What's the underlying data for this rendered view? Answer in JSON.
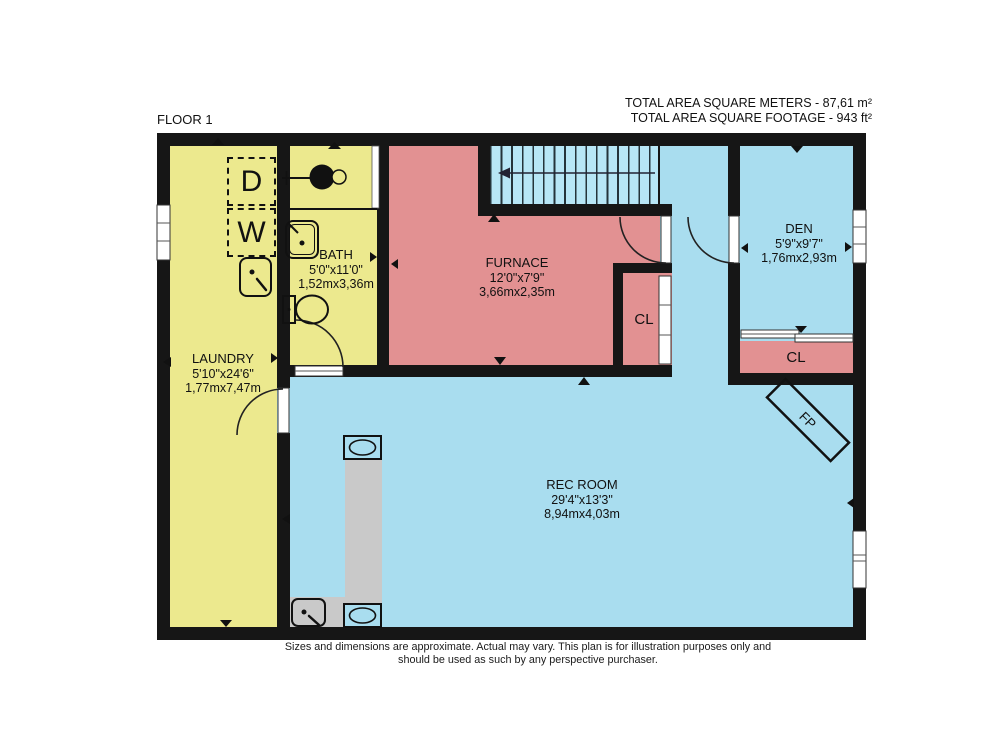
{
  "header": {
    "floor_label": "FLOOR 1",
    "total_area_meters": "TOTAL AREA SQUARE METERS - 87,61 m²",
    "total_area_footage": "TOTAL AREA SQUARE FOOTAGE  - 943 ft²"
  },
  "rooms": {
    "laundry": {
      "name": "LAUNDRY",
      "size_ft": "5'10\"x24'6\"",
      "size_m": "1,77mx7,47m"
    },
    "bath": {
      "name": "BATH",
      "size_ft": "5'0\"x11'0\"",
      "size_m": "1,52mx3,36m"
    },
    "furnace": {
      "name": "FURNACE",
      "size_ft": "12'0\"x7'9\"",
      "size_m": "3,66mx2,35m"
    },
    "den": {
      "name": "DEN",
      "size_ft": "5'9\"x9'7\"",
      "size_m": "1,76mx2,93m"
    },
    "rec_room": {
      "name": "REC ROOM",
      "size_ft": "29'4\"x13'3\"",
      "size_m": "8,94mx4,03m"
    },
    "closet_hall": {
      "label": "CL"
    },
    "closet_den": {
      "label": "CL"
    }
  },
  "appliances": {
    "dryer": "D",
    "washer": "W",
    "fireplace": "FP"
  },
  "footer": {
    "line1": "Sizes and dimensions are approximate. Actual may vary. This plan is for illustration purposes only and",
    "line2": "should be used as such by any perspective purchaser."
  },
  "colors": {
    "wall": "#161616",
    "yellow": "#ECE98E",
    "pink": "#E29192",
    "blue": "#A9DDEF",
    "stairs_blue": "#B7E6F6",
    "gray": "#C9C9C9",
    "window": "#FFFFFF"
  }
}
